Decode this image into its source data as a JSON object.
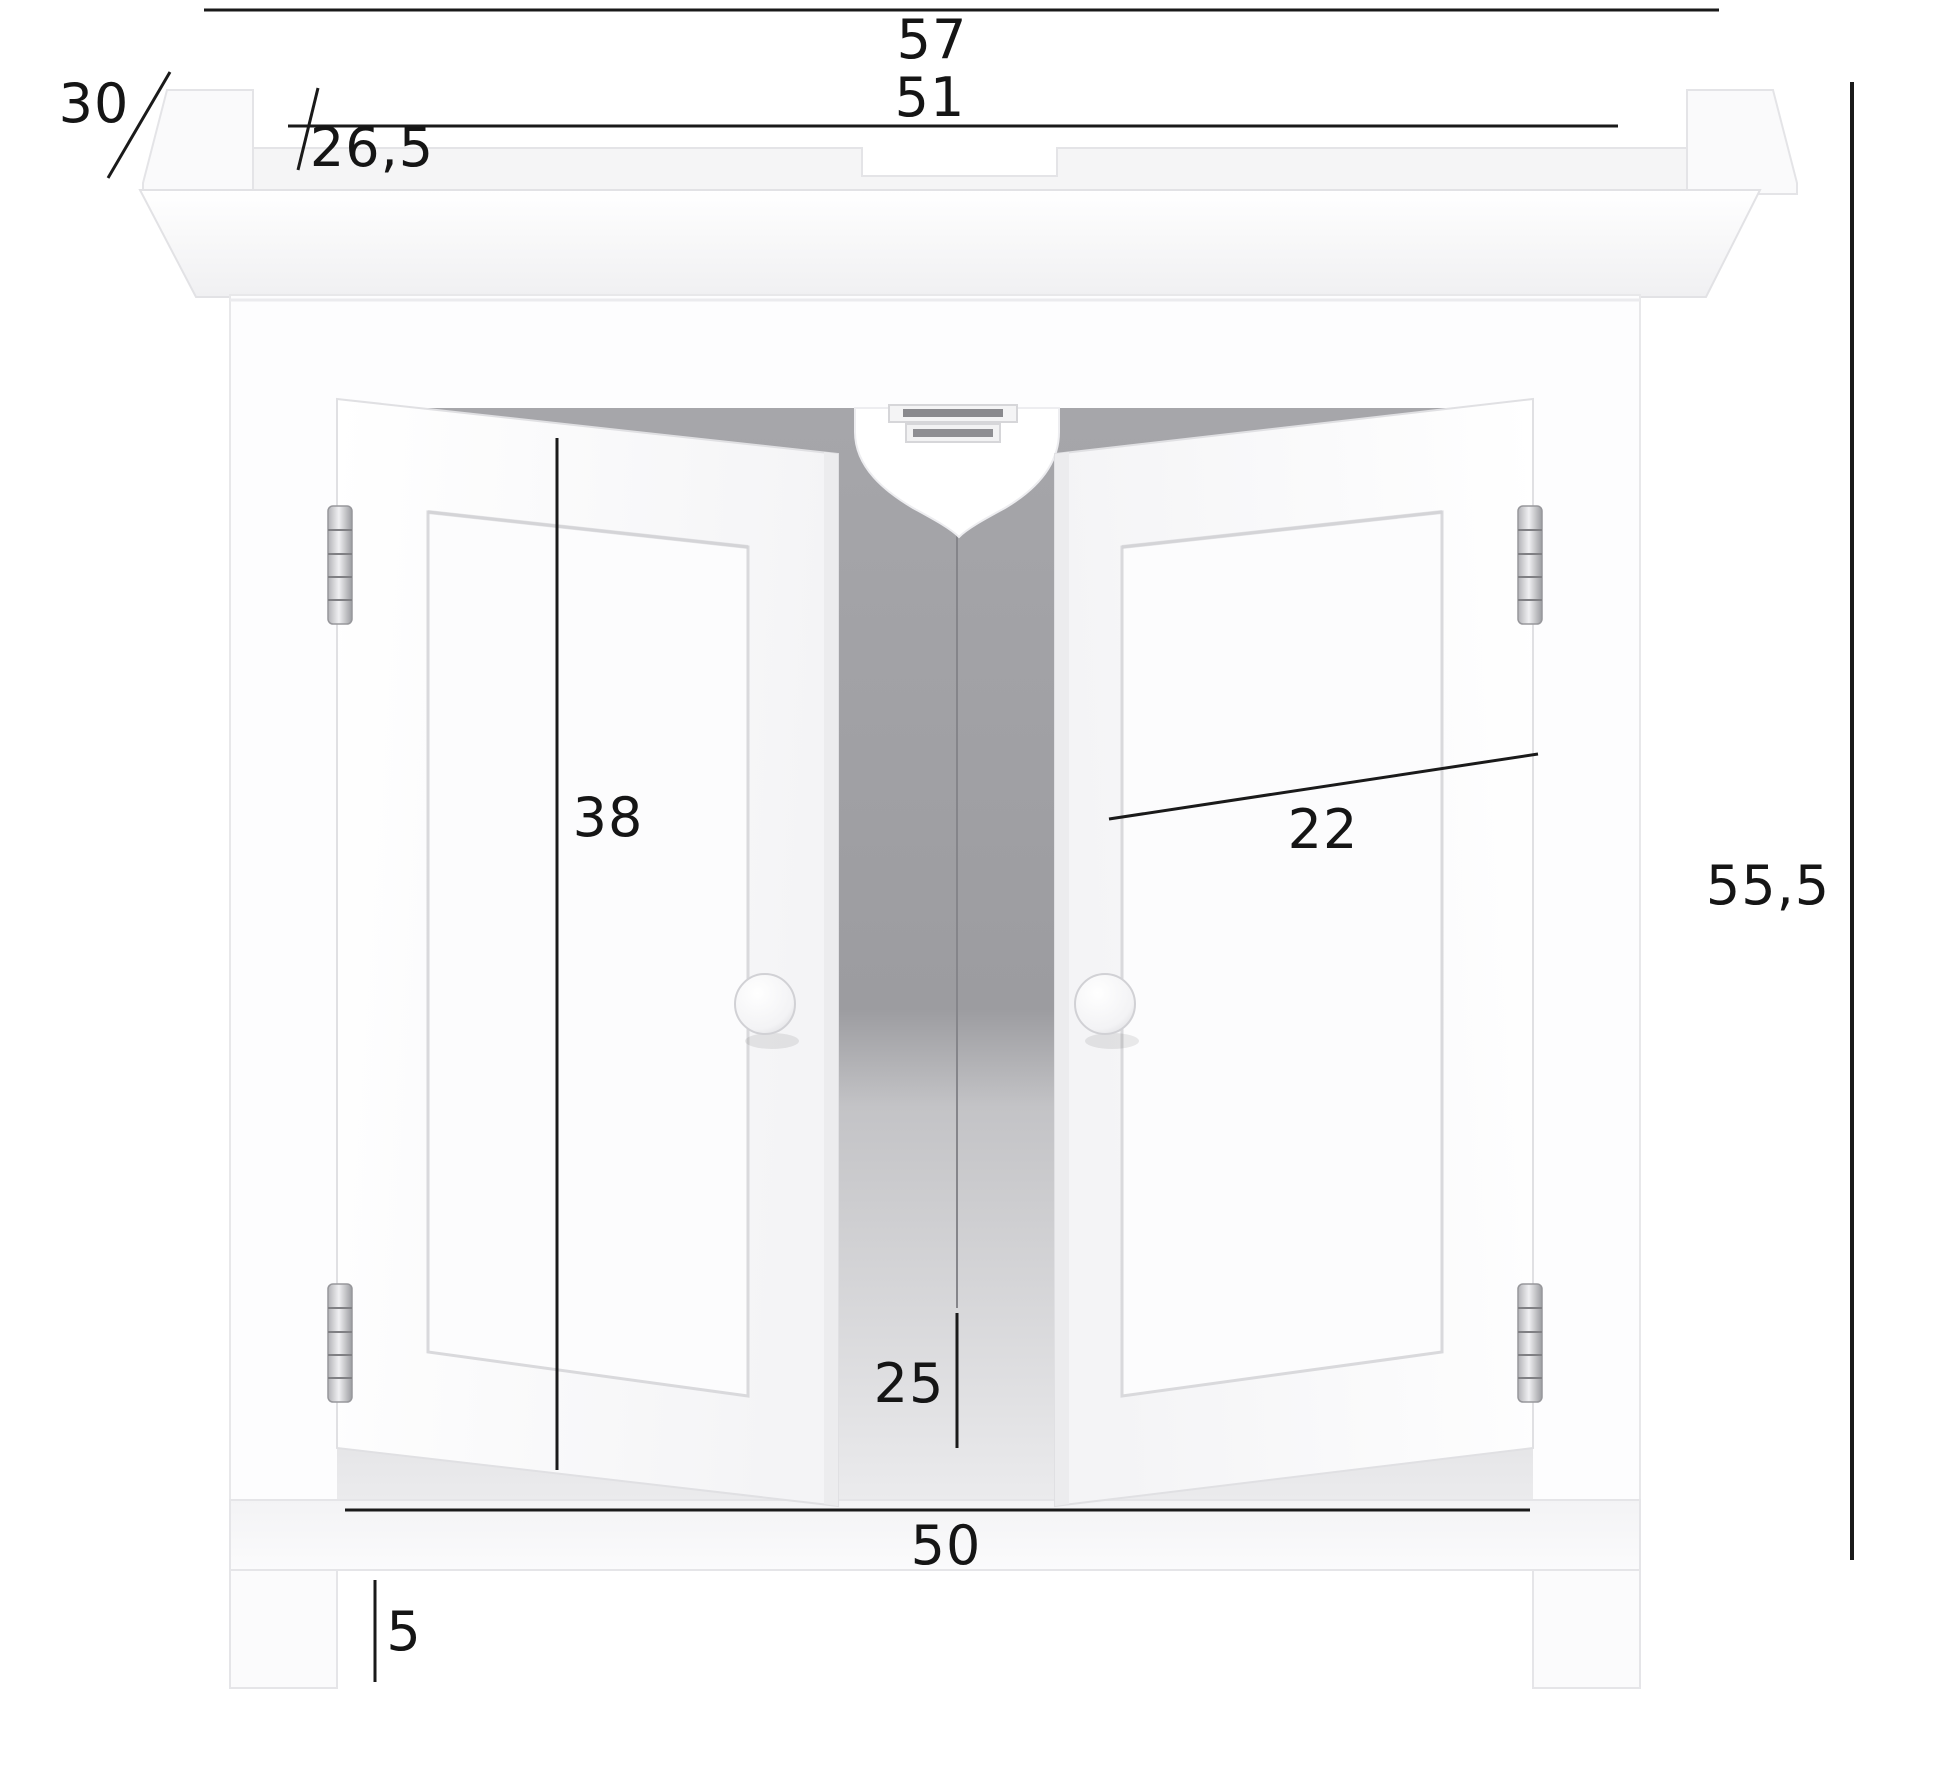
{
  "figure": {
    "type": "furniture dimension diagram",
    "subject": "two-door under-sink bathroom vanity cabinet",
    "dimension_labels": {
      "top_width": "57",
      "top_inner_width": "51",
      "top_recess": "26,5",
      "depth": "30",
      "height": "55,5",
      "door_width": "22",
      "door_height": "38",
      "siphon_gap_height": "25",
      "bottom_inner_width": "50",
      "leg_height": "5"
    },
    "colors": {
      "dimension_line": "#1a1a1a",
      "cabinet_white": "#ffffff",
      "interior_gray": "#a6a6aa",
      "hardware_silver": "#c9c9cd",
      "background": "#ffffff"
    }
  }
}
